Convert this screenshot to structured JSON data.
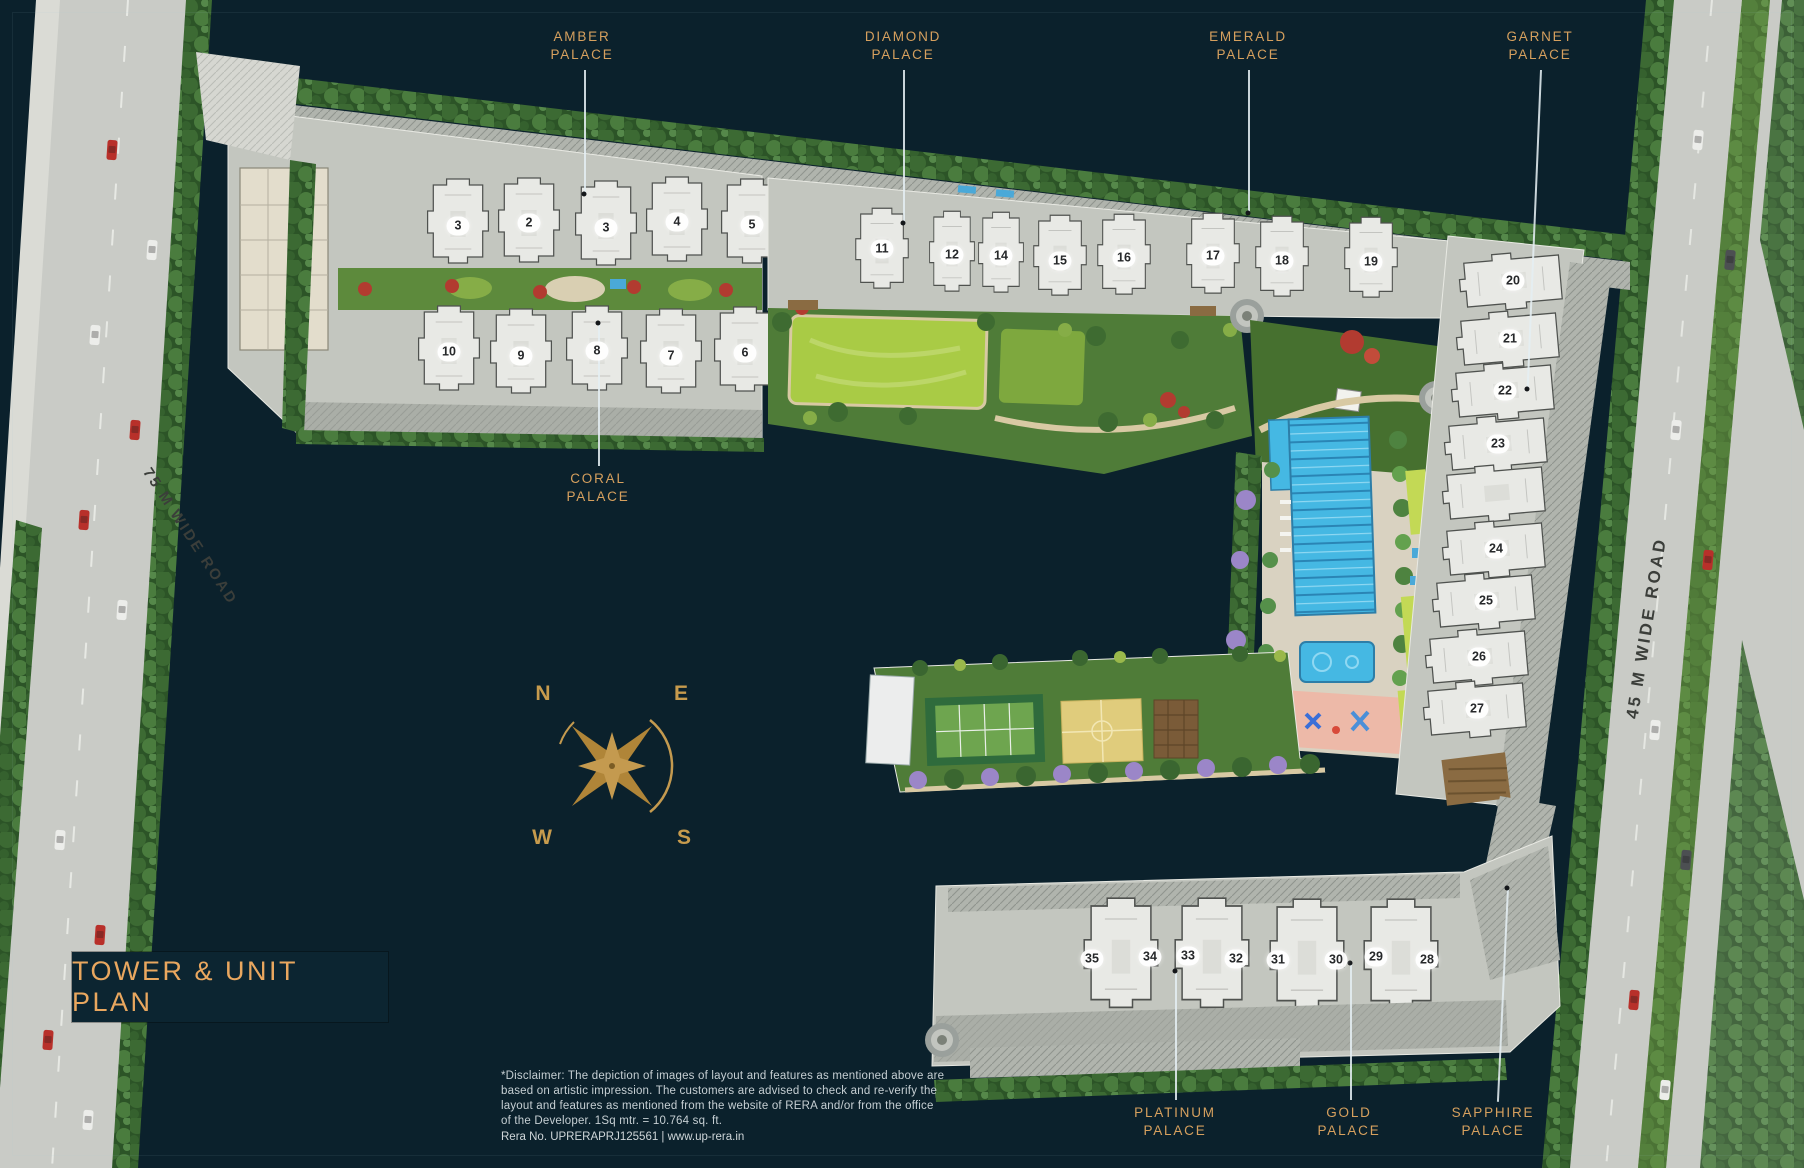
{
  "title": {
    "text": "TOWER & UNIT PLAN"
  },
  "palaces": {
    "amber": {
      "name": "AMBER",
      "type": "PALACE"
    },
    "diamond": {
      "name": "DIAMOND",
      "type": "PALACE"
    },
    "emerald": {
      "name": "EMERALD",
      "type": "PALACE"
    },
    "garnet": {
      "name": "GARNET",
      "type": "PALACE"
    },
    "coral": {
      "name": "CORAL",
      "type": "PALACE"
    },
    "platinum": {
      "name": "PLATINUM",
      "type": "PALACE"
    },
    "gold": {
      "name": "GOLD",
      "type": "PALACE"
    },
    "sapphire": {
      "name": "SAPPHIRE",
      "type": "PALACE"
    }
  },
  "roads": {
    "west": "75 M WIDE ROAD",
    "east": "45 M WIDE ROAD"
  },
  "compass": {
    "n": "N",
    "e": "E",
    "w": "W",
    "s": "S"
  },
  "towers": {
    "row1": [
      "3",
      "2",
      "3",
      "4",
      "5"
    ],
    "row2": [
      "10",
      "9",
      "8",
      "7",
      "6"
    ],
    "row3": [
      "11",
      "12",
      "14",
      "15",
      "16",
      "17",
      "18",
      "19"
    ],
    "column": [
      "20",
      "21",
      "22",
      "23",
      "24",
      "25",
      "26",
      "27"
    ],
    "row4": [
      "35",
      "34",
      "33",
      "32",
      "31",
      "30",
      "29",
      "28"
    ]
  },
  "disclaimer": {
    "lines": [
      "*Disclaimer: The depiction of images of layout and features as mentioned above are",
      "based on artistic impression. The customers are advised to check and re-verify the",
      "layout and features as mentioned from the website of RERA and/or from the office",
      "of the Developer. 1Sq mtr. = 10.764 sq. ft."
    ],
    "rera": "Rera No. UPRERAPRJ125561 | www.up-rera.in"
  },
  "colors": {
    "background": "#0B212C",
    "gold_text": "#D6A05E",
    "leader_line": "#E4EEF2",
    "pool_blue": "#45B8E3",
    "building": "#E8E9E5",
    "road_grey": "#C9CBC6"
  }
}
